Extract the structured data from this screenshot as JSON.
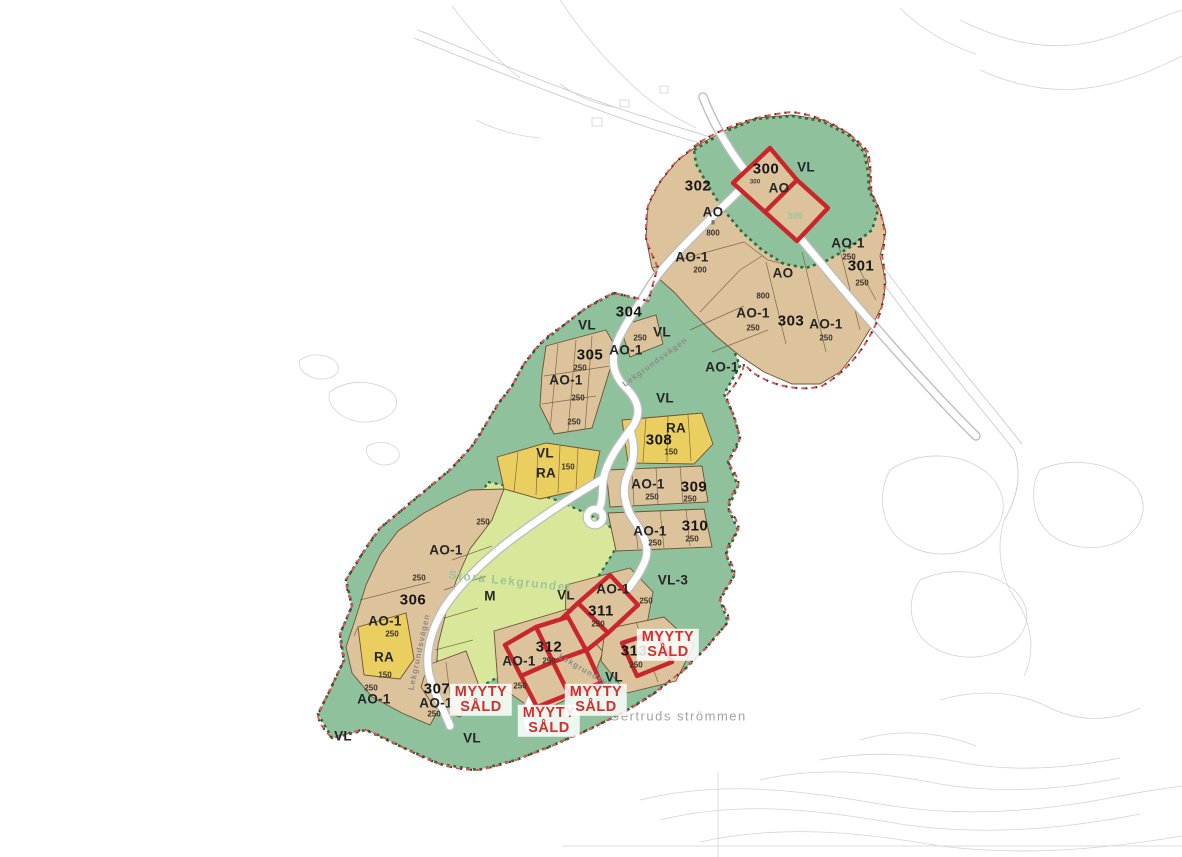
{
  "map": {
    "colors": {
      "ao_plot_fill": "#dcc39c",
      "vl_green_fill": "#8fc19c",
      "m_lightgreen_fill": "#d9e79b",
      "ra_yellow_fill": "#eace5f",
      "sold_outline_red": "#c9262c",
      "boundary_red": "#e25553",
      "stamp_text_red": "#d2302c",
      "faint_green_text": "#9cc59b"
    },
    "sold_stamps": {
      "lines": [
        "MYYTY",
        "SÅLD"
      ],
      "positions": [
        {
          "x": 668,
          "y": 645
        },
        {
          "x": 481,
          "y": 700
        },
        {
          "x": 549,
          "y": 721
        },
        {
          "x": 596,
          "y": 700
        }
      ]
    },
    "labels": [
      {
        "text": "300",
        "x": 766,
        "y": 169,
        "type": "plot"
      },
      {
        "text": "300",
        "x": 755,
        "y": 182,
        "type": "tiny"
      },
      {
        "text": "AO",
        "x": 779,
        "y": 188,
        "type": "zone"
      },
      {
        "text": "302",
        "x": 698,
        "y": 186,
        "type": "plot"
      },
      {
        "text": "AO",
        "x": 713,
        "y": 212,
        "type": "zone"
      },
      {
        "text": "II",
        "x": 713,
        "y": 223,
        "type": "tiny"
      },
      {
        "text": "800",
        "x": 713,
        "y": 233,
        "type": "num"
      },
      {
        "text": "VL",
        "x": 806,
        "y": 167,
        "type": "zone"
      },
      {
        "text": "300",
        "x": 795,
        "y": 216,
        "type": "faint"
      },
      {
        "text": "AO-1",
        "x": 692,
        "y": 257,
        "type": "zone"
      },
      {
        "text": "200",
        "x": 700,
        "y": 270,
        "type": "num"
      },
      {
        "text": "AO-1",
        "x": 848,
        "y": 243,
        "type": "zone"
      },
      {
        "text": "250",
        "x": 849,
        "y": 257,
        "type": "num"
      },
      {
        "text": "301",
        "x": 861,
        "y": 266,
        "type": "plot"
      },
      {
        "text": "250",
        "x": 862,
        "y": 283,
        "type": "num"
      },
      {
        "text": "AO",
        "x": 783,
        "y": 273,
        "type": "zone"
      },
      {
        "text": "800",
        "x": 763,
        "y": 296,
        "type": "num"
      },
      {
        "text": "AO-1",
        "x": 753,
        "y": 313,
        "type": "zone"
      },
      {
        "text": "250",
        "x": 753,
        "y": 328,
        "type": "num"
      },
      {
        "text": "303",
        "x": 791,
        "y": 321,
        "type": "plot"
      },
      {
        "text": "AO-1",
        "x": 826,
        "y": 324,
        "type": "zone"
      },
      {
        "text": "250",
        "x": 826,
        "y": 338,
        "type": "num"
      },
      {
        "text": "AO-1",
        "x": 722,
        "y": 367,
        "type": "zone"
      },
      {
        "text": "304",
        "x": 629,
        "y": 312,
        "type": "plot"
      },
      {
        "text": "VL",
        "x": 587,
        "y": 325,
        "type": "zone"
      },
      {
        "text": "VL",
        "x": 662,
        "y": 332,
        "type": "zone"
      },
      {
        "text": "250",
        "x": 640,
        "y": 338,
        "type": "num"
      },
      {
        "text": "AO-1",
        "x": 626,
        "y": 350,
        "type": "zone"
      },
      {
        "text": "305",
        "x": 590,
        "y": 355,
        "type": "plot"
      },
      {
        "text": "250",
        "x": 580,
        "y": 368,
        "type": "num"
      },
      {
        "text": "AO-1",
        "x": 566,
        "y": 380,
        "type": "zone"
      },
      {
        "text": "250",
        "x": 578,
        "y": 398,
        "type": "num"
      },
      {
        "text": "250",
        "x": 574,
        "y": 422,
        "type": "num"
      },
      {
        "text": "VL",
        "x": 665,
        "y": 398,
        "type": "zone"
      },
      {
        "text": "RA",
        "x": 676,
        "y": 428,
        "type": "zone"
      },
      {
        "text": "308",
        "x": 659,
        "y": 440,
        "type": "plot"
      },
      {
        "text": "150",
        "x": 671,
        "y": 452,
        "type": "num"
      },
      {
        "text": "VL",
        "x": 545,
        "y": 453,
        "type": "zone"
      },
      {
        "text": "RA",
        "x": 546,
        "y": 473,
        "type": "zone"
      },
      {
        "text": "150",
        "x": 568,
        "y": 467,
        "type": "num"
      },
      {
        "text": "AO-1",
        "x": 648,
        "y": 484,
        "type": "zone"
      },
      {
        "text": "250",
        "x": 652,
        "y": 497,
        "type": "num"
      },
      {
        "text": "309",
        "x": 694,
        "y": 487,
        "type": "plot"
      },
      {
        "text": "250",
        "x": 690,
        "y": 499,
        "type": "num"
      },
      {
        "text": "AO-1",
        "x": 650,
        "y": 531,
        "type": "zone"
      },
      {
        "text": "250",
        "x": 655,
        "y": 543,
        "type": "num"
      },
      {
        "text": "310",
        "x": 695,
        "y": 526,
        "type": "plot"
      },
      {
        "text": "250",
        "x": 692,
        "y": 539,
        "type": "num"
      },
      {
        "text": "250",
        "x": 483,
        "y": 522,
        "type": "num"
      },
      {
        "text": "AO-1",
        "x": 446,
        "y": 550,
        "type": "zone"
      },
      {
        "text": "250",
        "x": 419,
        "y": 578,
        "type": "num"
      },
      {
        "text": "306",
        "x": 413,
        "y": 600,
        "type": "plot"
      },
      {
        "text": "AO-1",
        "x": 385,
        "y": 621,
        "type": "zone"
      },
      {
        "text": "250",
        "x": 392,
        "y": 634,
        "type": "num"
      },
      {
        "text": "RA",
        "x": 384,
        "y": 657,
        "type": "zone"
      },
      {
        "text": "150",
        "x": 385,
        "y": 675,
        "type": "num"
      },
      {
        "text": "250",
        "x": 371,
        "y": 688,
        "type": "num"
      },
      {
        "text": "AO-1",
        "x": 374,
        "y": 699,
        "type": "zone"
      },
      {
        "text": "307",
        "x": 437,
        "y": 689,
        "type": "plot"
      },
      {
        "text": "AO-1",
        "x": 436,
        "y": 703,
        "type": "zone"
      },
      {
        "text": "250",
        "x": 434,
        "y": 714,
        "type": "num"
      },
      {
        "text": "M",
        "x": 490,
        "y": 596,
        "type": "zone"
      },
      {
        "text": "VL",
        "x": 566,
        "y": 595,
        "type": "zone"
      },
      {
        "text": "VL-3",
        "x": 673,
        "y": 580,
        "type": "zone"
      },
      {
        "text": "AO-1",
        "x": 613,
        "y": 589,
        "type": "zone"
      },
      {
        "text": "250",
        "x": 646,
        "y": 601,
        "type": "num"
      },
      {
        "text": "311",
        "x": 601,
        "y": 611,
        "type": "plot"
      },
      {
        "text": "250",
        "x": 598,
        "y": 624,
        "type": "num"
      },
      {
        "text": "312",
        "x": 549,
        "y": 647,
        "type": "plot"
      },
      {
        "text": "250",
        "x": 549,
        "y": 661,
        "type": "num"
      },
      {
        "text": "AO-1",
        "x": 519,
        "y": 661,
        "type": "zone"
      },
      {
        "text": "250",
        "x": 520,
        "y": 686,
        "type": "num"
      },
      {
        "text": "313",
        "x": 634,
        "y": 651,
        "type": "plot"
      },
      {
        "text": "250",
        "x": 636,
        "y": 665,
        "type": "num"
      },
      {
        "text": "VL",
        "x": 614,
        "y": 677,
        "type": "zone"
      },
      {
        "text": "VL",
        "x": 343,
        "y": 736,
        "type": "zone"
      },
      {
        "text": "VL",
        "x": 472,
        "y": 738,
        "type": "zone"
      },
      {
        "text": "Lekgrundsvägen",
        "x": 655,
        "y": 362,
        "type": "road",
        "rot": -36
      },
      {
        "text": "Lekgrundsvägen",
        "x": 419,
        "y": 652,
        "type": "road",
        "rot": -78
      },
      {
        "text": "Lekgrundsvägen",
        "x": 593,
        "y": 675,
        "type": "road",
        "rot": 30
      },
      {
        "text": "Stora Lekgrundet",
        "x": 510,
        "y": 581,
        "type": "area",
        "rot": 6
      },
      {
        "text": "Gertruds strömmen",
        "x": 678,
        "y": 716,
        "type": "water"
      }
    ]
  }
}
